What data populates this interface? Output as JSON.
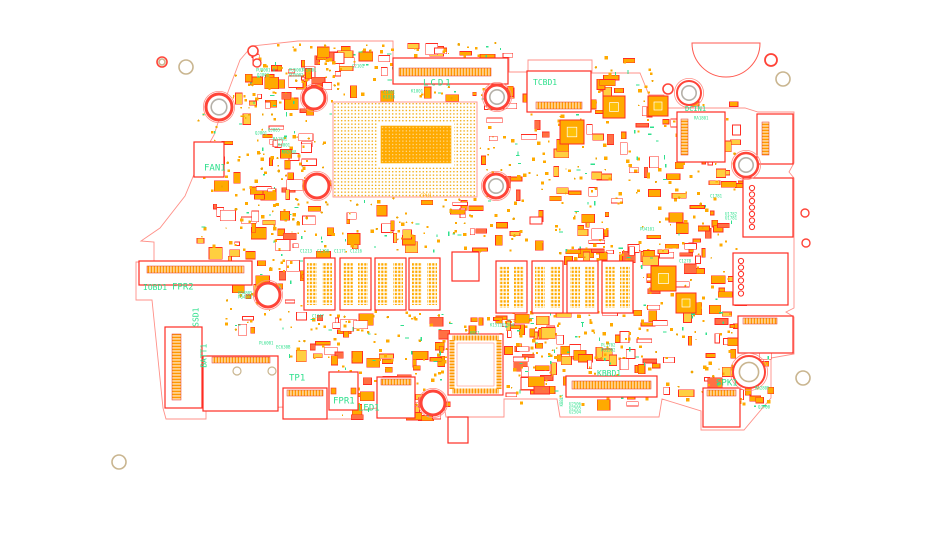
{
  "diagram_type": "pcb-boardview",
  "colors": {
    "silk_red": "#ff2d23",
    "silk_red_light": "#ff9088",
    "pad_orange": "#ffaa00",
    "via_gold": "#f0a500",
    "label_green": "#2fe08d",
    "hole_tan": "#c9b58f",
    "hole_gray": "#b5b0a8",
    "board_bg": "#ffffff"
  },
  "board": {
    "seed": 1337,
    "outline_path": "M252,46 L298,41 L393,41 L393,58 L509,58 L509,72 L528,72 L528,60 L592,60 L592,73 L640,73 L649,95 L664,95 L666,108 L745,108 L758,112 L794,112 L794,163 L789,172 L794,178 L794,308 L786,312 L794,317 L794,354 L771,358 L771,398 L744,430 L701,430 L701,411 L662,399 L659,417 L560,417 L557,399 L504,399 L504,417 L446,417 L443,399 L362,410 L362,419 L284,419 L284,407 L206,410 L206,419 L166,419 L163,408 L152,300 L136,300 L136,262 L154,262 L154,242 L141,241 L160,228 L185,196 L200,160 L214,135 L228,92 L240,60 Z",
    "semicircle": {
      "cx": 726,
      "cy": 43,
      "r": 34
    },
    "cpu": {
      "x": 333,
      "y": 102,
      "w": 144,
      "h": 95,
      "ix": 381,
      "iy": 126,
      "iw": 70,
      "ih": 37
    },
    "ddr": {
      "w": 31,
      "h": 52,
      "chips": [
        [
          304,
          258
        ],
        [
          340,
          258
        ],
        [
          375,
          258
        ],
        [
          409,
          258
        ],
        [
          496,
          261
        ],
        [
          532,
          261
        ],
        [
          567,
          261
        ],
        [
          602,
          261
        ]
      ]
    },
    "connectors": [
      {
        "id": "lcd1",
        "x": 393,
        "y": 58,
        "w": 115,
        "h": 26,
        "strip": {
          "x": 399,
          "y": 68,
          "w": 92,
          "h": 8,
          "dir": "h"
        }
      },
      {
        "id": "tcbd1",
        "x": 527,
        "y": 71,
        "w": 64,
        "h": 41,
        "strip": {
          "x": 536,
          "y": 102,
          "w": 46,
          "h": 7,
          "dir": "h"
        }
      },
      {
        "id": "dcin1",
        "x": 677,
        "y": 112,
        "w": 48,
        "h": 50,
        "strip": {
          "x": 681,
          "y": 119,
          "w": 7,
          "h": 36,
          "dir": "v"
        }
      },
      {
        "id": "usbc1",
        "x": 757,
        "y": 114,
        "w": 36,
        "h": 50,
        "strip": {
          "x": 762,
          "y": 122,
          "w": 7,
          "h": 33,
          "dir": "v"
        }
      },
      {
        "id": "usba1",
        "x": 743,
        "y": 178,
        "w": 50,
        "h": 59,
        "rings": {
          "x": 752,
          "y0": 188,
          "n": 7,
          "dy": 6.5,
          "r": 2.6
        }
      },
      {
        "id": "usba2",
        "x": 733,
        "y": 253,
        "w": 55,
        "h": 52,
        "rings": {
          "x": 741,
          "y0": 261,
          "n": 6,
          "dy": 6.5,
          "r": 2.6
        }
      },
      {
        "id": "audio1",
        "x": 738,
        "y": 316,
        "w": 55,
        "h": 37,
        "strip": {
          "x": 743,
          "y": 318,
          "w": 34,
          "h": 6,
          "dir": "h"
        }
      },
      {
        "id": "iobd1",
        "x": 139,
        "y": 261,
        "w": 113,
        "h": 24,
        "strip": {
          "x": 147,
          "y": 266,
          "w": 97,
          "h": 7,
          "dir": "h"
        }
      },
      {
        "id": "fan1",
        "x": 194,
        "y": 142,
        "w": 30,
        "h": 35
      },
      {
        "id": "batt1",
        "x": 165,
        "y": 327,
        "w": 37,
        "h": 81,
        "strip": {
          "x": 172,
          "y": 334,
          "w": 9,
          "h": 66,
          "dir": "v"
        }
      },
      {
        "id": "wlan1",
        "x": 203,
        "y": 356,
        "w": 75,
        "h": 55,
        "strip": {
          "x": 212,
          "y": 357,
          "w": 58,
          "h": 6,
          "dir": "h"
        }
      },
      {
        "id": "tp1",
        "x": 283,
        "y": 388,
        "w": 44,
        "h": 31,
        "strip": {
          "x": 287,
          "y": 390,
          "w": 36,
          "h": 6,
          "dir": "h"
        }
      },
      {
        "id": "fpr1",
        "x": 329,
        "y": 372,
        "w": 29,
        "h": 38,
        "sidepads": true
      },
      {
        "id": "led1",
        "x": 377,
        "y": 377,
        "w": 38,
        "h": 41,
        "strip": {
          "x": 381,
          "y": 379,
          "w": 30,
          "h": 6,
          "dir": "h"
        }
      },
      {
        "id": "kbbd1",
        "x": 566,
        "y": 376,
        "w": 91,
        "h": 21,
        "strip": {
          "x": 572,
          "y": 381,
          "w": 79,
          "h": 8,
          "dir": "h"
        }
      },
      {
        "id": "spk1",
        "x": 703,
        "y": 388,
        "w": 37,
        "h": 39,
        "strip": {
          "x": 707,
          "y": 390,
          "w": 29,
          "h": 6,
          "dir": "h"
        }
      },
      {
        "id": "misc1",
        "x": 448,
        "y": 417,
        "w": 20,
        "h": 26
      },
      {
        "id": "nc1",
        "x": 452,
        "y": 252,
        "w": 27,
        "h": 29
      }
    ],
    "qfp": {
      "x": 448,
      "y": 334,
      "w": 55,
      "h": 61
    },
    "qfns": [
      {
        "x": 603,
        "y": 96,
        "s": 22
      },
      {
        "x": 648,
        "y": 96,
        "s": 20
      },
      {
        "x": 560,
        "y": 120,
        "s": 24
      },
      {
        "x": 651,
        "y": 266,
        "s": 25
      },
      {
        "x": 676,
        "y": 293,
        "s": 20
      }
    ],
    "holes": [
      {
        "x": 219,
        "y": 107,
        "r": 13,
        "ring": "red",
        "rw": 3,
        "inner": "gray"
      },
      {
        "x": 314,
        "y": 98,
        "r": 11,
        "ring": "red",
        "rw": 3,
        "inner": null
      },
      {
        "x": 317,
        "y": 186,
        "r": 12,
        "ring": "red",
        "rw": 3,
        "inner": null
      },
      {
        "x": 268,
        "y": 295,
        "r": 12,
        "ring": "red",
        "rw": 3,
        "inner": null
      },
      {
        "x": 497,
        "y": 97,
        "r": 12,
        "ring": "red",
        "rw": 3,
        "inner": "gray"
      },
      {
        "x": 496,
        "y": 186,
        "r": 12,
        "ring": "red",
        "rw": 3,
        "inner": "gray"
      },
      {
        "x": 433,
        "y": 403,
        "r": 12,
        "ring": "red",
        "rw": 3,
        "inner": null
      },
      {
        "x": 746,
        "y": 165,
        "r": 12,
        "ring": "red",
        "rw": 2.5,
        "inner": "gray"
      },
      {
        "x": 749,
        "y": 372,
        "r": 16,
        "ring": "red",
        "rw": 2,
        "inner": "tan"
      },
      {
        "x": 689,
        "y": 93,
        "r": 12,
        "ring": "red",
        "rw": 2,
        "inner": "gray"
      },
      {
        "x": 162,
        "y": 62,
        "r": 5,
        "ring": "red",
        "rw": 1.6,
        "inner": "tan"
      },
      {
        "x": 186,
        "y": 67,
        "r": 7,
        "ring": "tan",
        "rw": 1.6,
        "inner": null
      },
      {
        "x": 253,
        "y": 51,
        "r": 5,
        "ring": "red",
        "rw": 1.6,
        "inner": null
      },
      {
        "x": 257,
        "y": 63,
        "r": 4,
        "ring": "red",
        "rw": 1.4,
        "inner": null
      },
      {
        "x": 668,
        "y": 89,
        "r": 5,
        "ring": "red",
        "rw": 1.6,
        "inner": null
      },
      {
        "x": 771,
        "y": 60,
        "r": 6,
        "ring": "red",
        "rw": 1.8,
        "inner": null
      },
      {
        "x": 783,
        "y": 79,
        "r": 7,
        "ring": "tan",
        "rw": 1.6,
        "inner": null
      },
      {
        "x": 805,
        "y": 213,
        "r": 4,
        "ring": "red",
        "rw": 1.4,
        "inner": null
      },
      {
        "x": 806,
        "y": 243,
        "r": 4,
        "ring": "red",
        "rw": 1.4,
        "inner": null
      },
      {
        "x": 803,
        "y": 378,
        "r": 7,
        "ring": "tan",
        "rw": 1.6,
        "inner": null
      },
      {
        "x": 119,
        "y": 462,
        "r": 7,
        "ring": "tan",
        "rw": 1.6,
        "inner": null
      },
      {
        "x": 237,
        "y": 371,
        "r": 4,
        "ring": "tan",
        "rw": 1.2,
        "inner": null
      },
      {
        "x": 272,
        "y": 371,
        "r": 4,
        "ring": "tan",
        "rw": 1.2,
        "inner": null
      }
    ],
    "labels_major": [
      {
        "text": "FAN1",
        "x": 204,
        "y": 163,
        "size": 9
      },
      {
        "text": "LCD1",
        "x": 423,
        "y": 78,
        "size": 9,
        "ls": 2
      },
      {
        "text": "TCBD1",
        "x": 533,
        "y": 78,
        "size": 8
      },
      {
        "text": "DCIN1",
        "x": 685,
        "y": 105,
        "size": 7
      },
      {
        "text": "IOBD1",
        "x": 143,
        "y": 283,
        "size": 8
      },
      {
        "text": "FPR2",
        "x": 172,
        "y": 282,
        "size": 9
      },
      {
        "text": "SSD1",
        "x": 192,
        "y": 303,
        "size": 8,
        "vertical": true
      },
      {
        "text": "BATT1",
        "x": 200,
        "y": 339,
        "size": 8,
        "vertical": true
      },
      {
        "text": "TP1",
        "x": 289,
        "y": 373,
        "size": 9
      },
      {
        "text": "FPR1",
        "x": 333,
        "y": 396,
        "size": 9
      },
      {
        "text": "LED1",
        "x": 358,
        "y": 403,
        "size": 9
      },
      {
        "text": "KBBD1",
        "x": 597,
        "y": 369,
        "size": 8
      },
      {
        "text": "SPK1",
        "x": 716,
        "y": 378,
        "size": 9
      },
      {
        "text": "CPU1",
        "x": 420,
        "y": 193,
        "size": 5,
        "color": "#ffaa00"
      },
      {
        "text": "KBBL1",
        "x": 560,
        "y": 392,
        "size": 4,
        "vertical": true
      }
    ],
    "labels_small": [
      {
        "text": "PU8001",
        "x": 256,
        "y": 68
      },
      {
        "text": "QJ802",
        "x": 257,
        "y": 73
      },
      {
        "text": "PU5003",
        "x": 289,
        "y": 68
      },
      {
        "text": "PL5001",
        "x": 302,
        "y": 68
      },
      {
        "text": "PU5002",
        "x": 289,
        "y": 73
      },
      {
        "text": "C2101",
        "x": 352,
        "y": 64
      },
      {
        "text": "C1801",
        "x": 383,
        "y": 90
      },
      {
        "text": "K1810",
        "x": 383,
        "y": 95
      },
      {
        "text": "K1801",
        "x": 411,
        "y": 89
      },
      {
        "text": "QJ805",
        "x": 268,
        "y": 128
      },
      {
        "text": "QJ801",
        "x": 255,
        "y": 131
      },
      {
        "text": "RA1802",
        "x": 273,
        "y": 137
      },
      {
        "text": "K4001",
        "x": 278,
        "y": 143
      },
      {
        "text": "KN2008",
        "x": 282,
        "y": 150
      },
      {
        "text": "C1213",
        "x": 300,
        "y": 249
      },
      {
        "text": "C1198",
        "x": 317,
        "y": 249
      },
      {
        "text": "C1171",
        "x": 334,
        "y": 249
      },
      {
        "text": "C1216",
        "x": 350,
        "y": 249
      },
      {
        "text": "C1278",
        "x": 679,
        "y": 259
      },
      {
        "text": "C1347",
        "x": 312,
        "y": 314
      },
      {
        "text": "K1511",
        "x": 490,
        "y": 323
      },
      {
        "text": "U1504",
        "x": 502,
        "y": 323
      },
      {
        "text": "PL6001",
        "x": 259,
        "y": 341
      },
      {
        "text": "EC630B",
        "x": 276,
        "y": 345
      },
      {
        "text": "PQ4805",
        "x": 238,
        "y": 291
      },
      {
        "text": "PQ4313",
        "x": 238,
        "y": 295
      },
      {
        "text": "PL1702",
        "x": 601,
        "y": 343
      },
      {
        "text": "PU1502",
        "x": 601,
        "y": 348
      },
      {
        "text": "KBC1",
        "x": 470,
        "y": 331
      },
      {
        "text": "U2506",
        "x": 569,
        "y": 402
      },
      {
        "text": "U2505",
        "x": 569,
        "y": 406
      },
      {
        "text": "U2504",
        "x": 569,
        "y": 410
      },
      {
        "text": "RA2805",
        "x": 755,
        "y": 386
      },
      {
        "text": "QJ700",
        "x": 758,
        "y": 405
      },
      {
        "text": "C1781",
        "x": 710,
        "y": 194
      },
      {
        "text": "U1782",
        "x": 725,
        "y": 212
      },
      {
        "text": "U1781",
        "x": 725,
        "y": 216
      },
      {
        "text": "PU4101",
        "x": 640,
        "y": 227
      },
      {
        "text": "RA1801",
        "x": 694,
        "y": 116
      }
    ],
    "clutter_zones": [
      {
        "x": 248,
        "y": 42,
        "w": 92,
        "h": 72,
        "r": 24,
        "p": 28,
        "v": 10,
        "t": 8
      },
      {
        "x": 300,
        "y": 44,
        "w": 95,
        "h": 52,
        "r": 18,
        "p": 22,
        "v": 8,
        "t": 7
      },
      {
        "x": 398,
        "y": 42,
        "w": 105,
        "h": 14,
        "r": 7,
        "p": 9,
        "v": 3,
        "t": 3
      },
      {
        "x": 195,
        "y": 112,
        "w": 112,
        "h": 140,
        "r": 38,
        "p": 44,
        "v": 16,
        "t": 14
      },
      {
        "x": 233,
        "y": 70,
        "w": 40,
        "h": 50,
        "r": 4,
        "p": 6,
        "v": 12,
        "t": 3
      },
      {
        "x": 258,
        "y": 130,
        "w": 70,
        "h": 105,
        "r": 14,
        "p": 18,
        "v": 26,
        "t": 6
      },
      {
        "x": 225,
        "y": 248,
        "w": 78,
        "h": 82,
        "r": 20,
        "p": 26,
        "v": 9,
        "t": 9
      },
      {
        "x": 480,
        "y": 93,
        "w": 78,
        "h": 152,
        "r": 24,
        "p": 30,
        "v": 10,
        "t": 10
      },
      {
        "x": 558,
        "y": 93,
        "w": 182,
        "h": 152,
        "r": 66,
        "p": 80,
        "v": 26,
        "t": 22
      },
      {
        "x": 558,
        "y": 246,
        "w": 100,
        "h": 14,
        "r": 9,
        "p": 12,
        "v": 4,
        "t": 4
      },
      {
        "x": 640,
        "y": 243,
        "w": 100,
        "h": 94,
        "r": 28,
        "p": 34,
        "v": 10,
        "t": 12
      },
      {
        "x": 285,
        "y": 310,
        "w": 272,
        "h": 50,
        "r": 50,
        "p": 62,
        "v": 18,
        "t": 18
      },
      {
        "x": 505,
        "y": 310,
        "w": 152,
        "h": 48,
        "r": 28,
        "p": 34,
        "v": 10,
        "t": 12
      },
      {
        "x": 330,
        "y": 358,
        "w": 122,
        "h": 58,
        "r": 24,
        "p": 28,
        "v": 10,
        "t": 10
      },
      {
        "x": 505,
        "y": 352,
        "w": 162,
        "h": 52,
        "r": 28,
        "p": 34,
        "v": 10,
        "t": 12
      },
      {
        "x": 660,
        "y": 330,
        "w": 112,
        "h": 76,
        "r": 22,
        "p": 26,
        "v": 8,
        "t": 10
      },
      {
        "x": 332,
        "y": 198,
        "w": 150,
        "h": 42,
        "r": 12,
        "p": 16,
        "v": 20,
        "t": 6
      },
      {
        "x": 300,
        "y": 228,
        "w": 345,
        "h": 24,
        "r": 16,
        "p": 24,
        "v": 8,
        "t": 8
      },
      {
        "x": 595,
        "y": 55,
        "w": 58,
        "h": 38,
        "r": 7,
        "p": 9,
        "v": 3,
        "t": 3
      },
      {
        "x": 412,
        "y": 86,
        "w": 96,
        "h": 14,
        "r": 6,
        "p": 8,
        "v": 3,
        "t": 3
      }
    ]
  }
}
